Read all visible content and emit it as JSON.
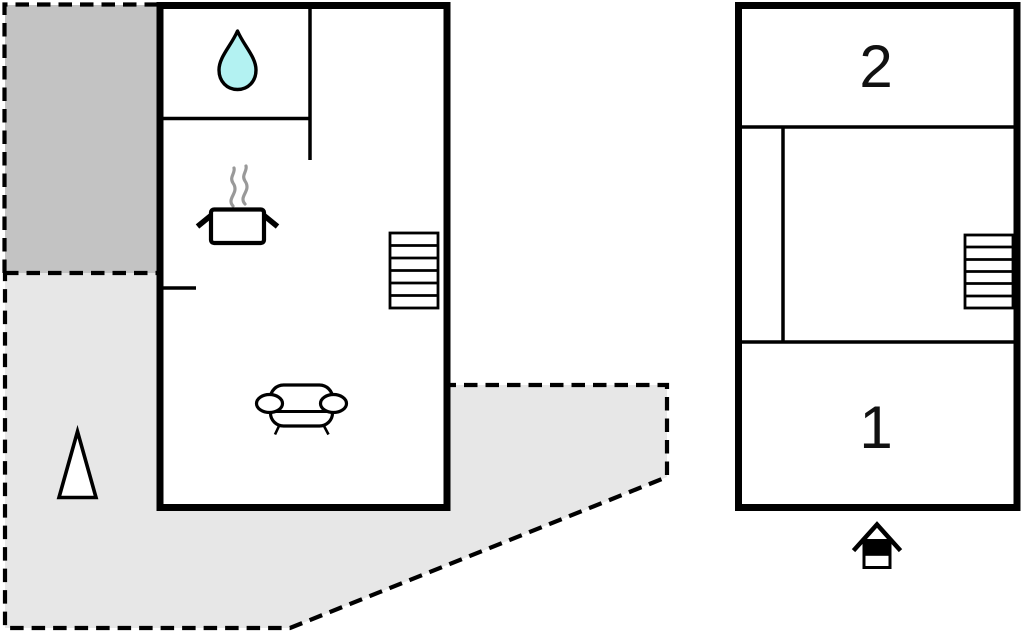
{
  "page": {
    "background": "#ffffff",
    "description_labels": []
  },
  "colors": {
    "wall": "#000000",
    "terrace_upper_fill": "#c3c3c3",
    "terrace_lower_fill": "#e7e7e7",
    "building_fill": "#ffffff",
    "water_drop_fill": "#b3f2f2",
    "steam_stroke": "#999999",
    "label_color": "#111111"
  },
  "ground_floor": {
    "areas": {
      "terrace_upper": "dashed-outdoor-area",
      "terrace_lower": "dashed-outdoor-area"
    },
    "icons": [
      "water-drop-icon",
      "cooking-pot-icon",
      "staircase-icon",
      "sofa-icon",
      "tree-icon"
    ]
  },
  "upper_floor": {
    "room_2_label": "2",
    "room_1_label": "1",
    "icons": [
      "staircase-icon",
      "house-entrance-icon"
    ]
  }
}
